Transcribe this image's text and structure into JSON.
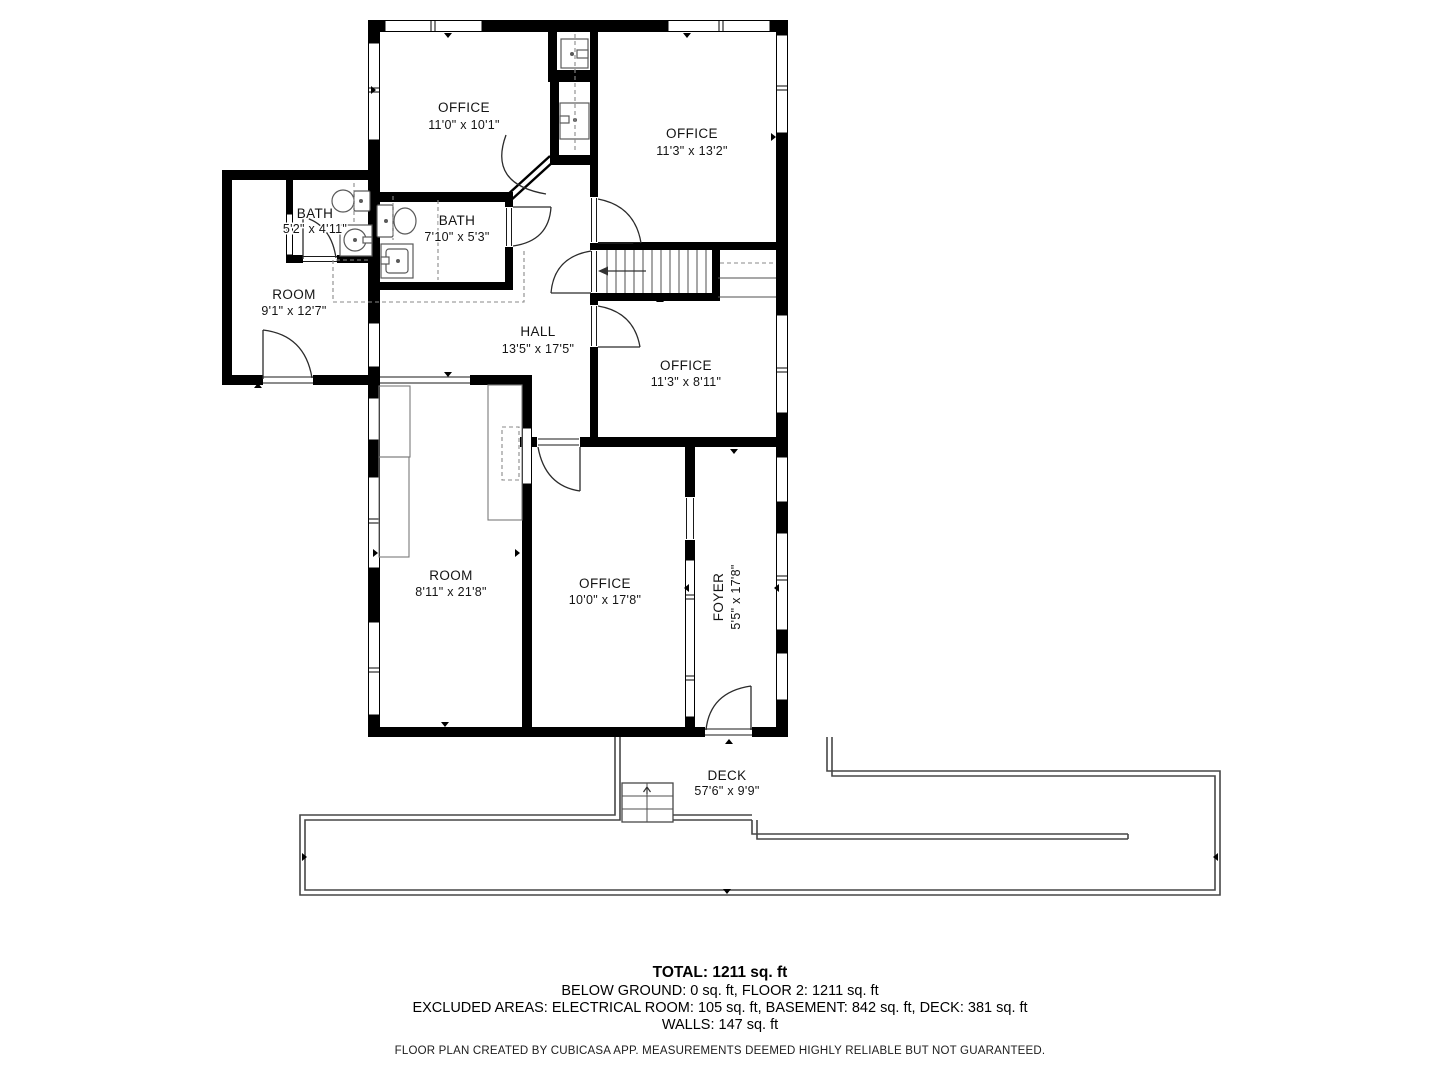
{
  "labels": {
    "office_top_left": {
      "name": "OFFICE",
      "dims": "11'0\" x 10'1\""
    },
    "office_top_right": {
      "name": "OFFICE",
      "dims": "11'3\" x 13'2\""
    },
    "bath_small": {
      "name": "BATH",
      "dims": "5'2\" x 4'11\""
    },
    "bath_main": {
      "name": "BATH",
      "dims": "7'10\" x 5'3\""
    },
    "room_annex": {
      "name": "ROOM",
      "dims": "9'1\" x 12'7\""
    },
    "hall": {
      "name": "HALL",
      "dims": "13'5\" x 17'5\""
    },
    "office_mid_right": {
      "name": "OFFICE",
      "dims": "11'3\" x 8'11\""
    },
    "room_lower": {
      "name": "ROOM",
      "dims": "8'11\" x 21'8\""
    },
    "office_lower": {
      "name": "OFFICE",
      "dims": "10'0\" x 17'8\""
    },
    "foyer": {
      "name": "FOYER",
      "dims": "5'5\" x 17'8\""
    },
    "deck": {
      "name": "DECK",
      "dims": "57'6\" x 9'9\""
    }
  },
  "summary": {
    "total": "TOTAL: 1211 sq. ft",
    "line2": "BELOW GROUND: 0 sq. ft, FLOOR 2: 1211 sq. ft",
    "line3": "EXCLUDED AREAS: ELECTRICAL ROOM: 105 sq. ft, BASEMENT: 842 sq. ft, DECK: 381 sq. ft",
    "line4": "WALLS: 147 sq. ft"
  },
  "disclaimer": "FLOOR PLAN CREATED BY CUBICASA APP. MEASUREMENTS DEEMED HIGHLY RELIABLE BUT NOT GUARANTEED.",
  "colors": {
    "walls": "#000000",
    "deck_outline": "#474747",
    "text": "#141414"
  }
}
